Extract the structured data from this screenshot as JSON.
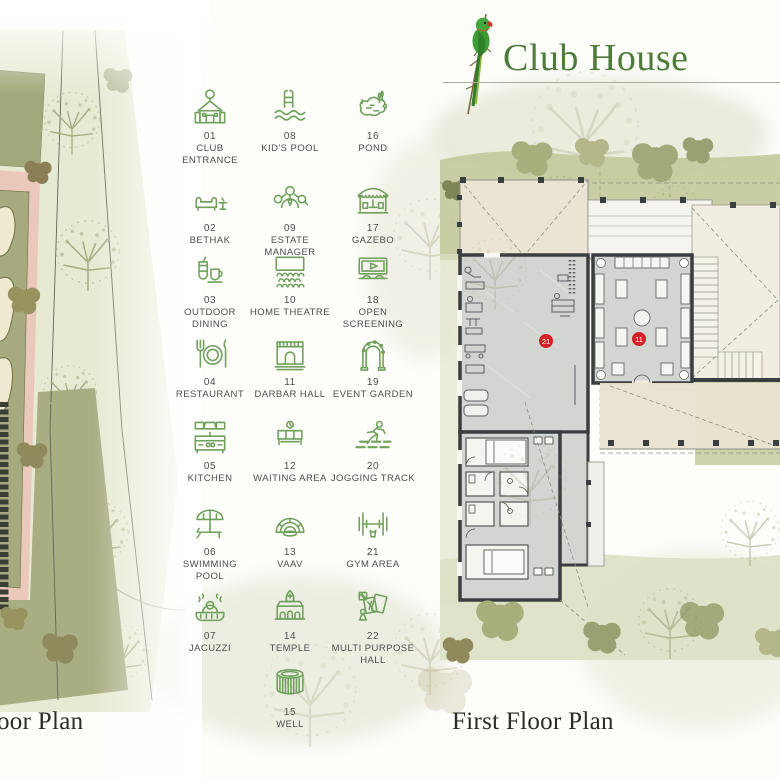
{
  "header": {
    "title": "Club House"
  },
  "legend": {
    "items": [
      {
        "number": "01",
        "label": "CLUB ENTRANCE"
      },
      {
        "number": "02",
        "label": "BETHAK"
      },
      {
        "number": "03",
        "label": "OUTDOOR DINING"
      },
      {
        "number": "04",
        "label": "RESTAURANT"
      },
      {
        "number": "05",
        "label": "KITCHEN"
      },
      {
        "number": "06",
        "label": "SWIMMING POOL"
      },
      {
        "number": "07",
        "label": "JACUZZI"
      },
      {
        "number": "08",
        "label": "KID'S POOL"
      },
      {
        "number": "09",
        "label": "ESTATE MANAGER"
      },
      {
        "number": "10",
        "label": "HOME THEATRE"
      },
      {
        "number": "11",
        "label": "DARBAR HALL"
      },
      {
        "number": "12",
        "label": "WAITING AREA"
      },
      {
        "number": "13",
        "label": "VAAV"
      },
      {
        "number": "14",
        "label": "TEMPLE"
      },
      {
        "number": "15",
        "label": "WELL"
      },
      {
        "number": "16",
        "label": "POND"
      },
      {
        "number": "17",
        "label": "GAZEBO"
      },
      {
        "number": "18",
        "label": "OPEN SCREENING"
      },
      {
        "number": "19",
        "label": "EVENT GARDEN"
      },
      {
        "number": "20",
        "label": "JOGGING TRACK"
      },
      {
        "number": "21",
        "label": "GYM AREA"
      },
      {
        "number": "22",
        "label": "MULTI PURPOSE HALL"
      }
    ]
  },
  "floor_plan": {
    "left_label": "oor Plan",
    "right_label": "First Floor Plan",
    "markers": [
      {
        "id": "21"
      },
      {
        "id": "11"
      }
    ]
  },
  "colors": {
    "accent_green": "#6FA05C",
    "title_green": "#4E7C3B",
    "marker_red": "#D32026",
    "label_gray": "#4D4D4C"
  }
}
